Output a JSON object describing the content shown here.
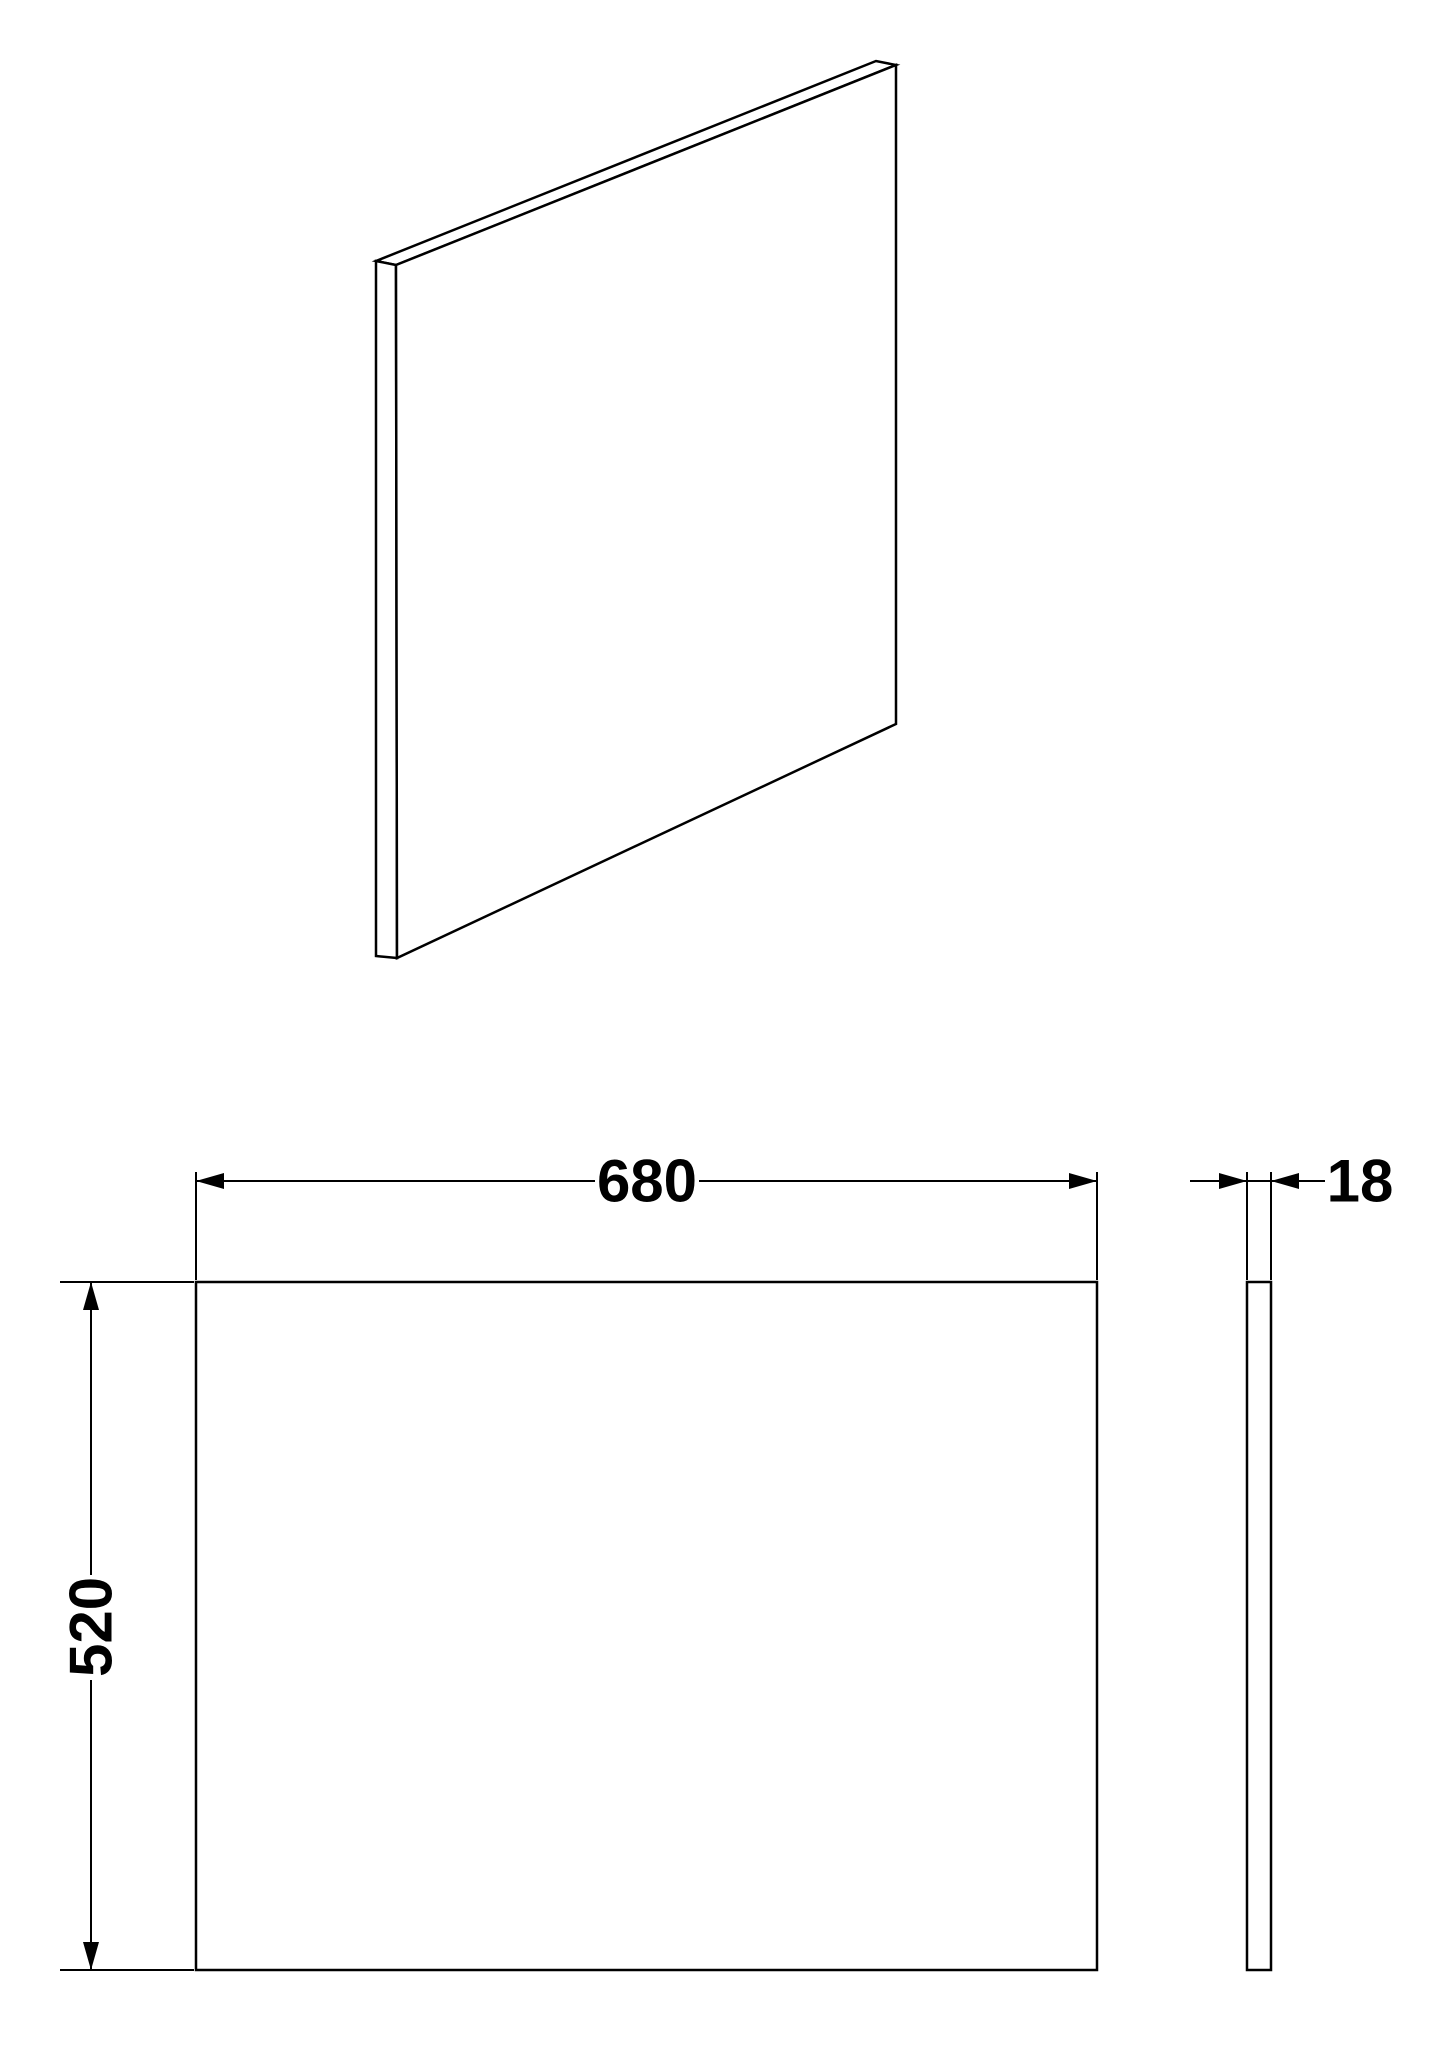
{
  "drawing": {
    "description": "technical dimension drawing of a flat rectangular panel",
    "colors": {
      "background": "#ffffff",
      "line": "#000000",
      "text": "#000000"
    },
    "views": {
      "isometric": "isometric view of thin panel",
      "front": "front view rectangle",
      "side": "side profile strip"
    },
    "dimensions": {
      "width_label": "680",
      "height_label": "520",
      "thickness_label": "18"
    }
  }
}
